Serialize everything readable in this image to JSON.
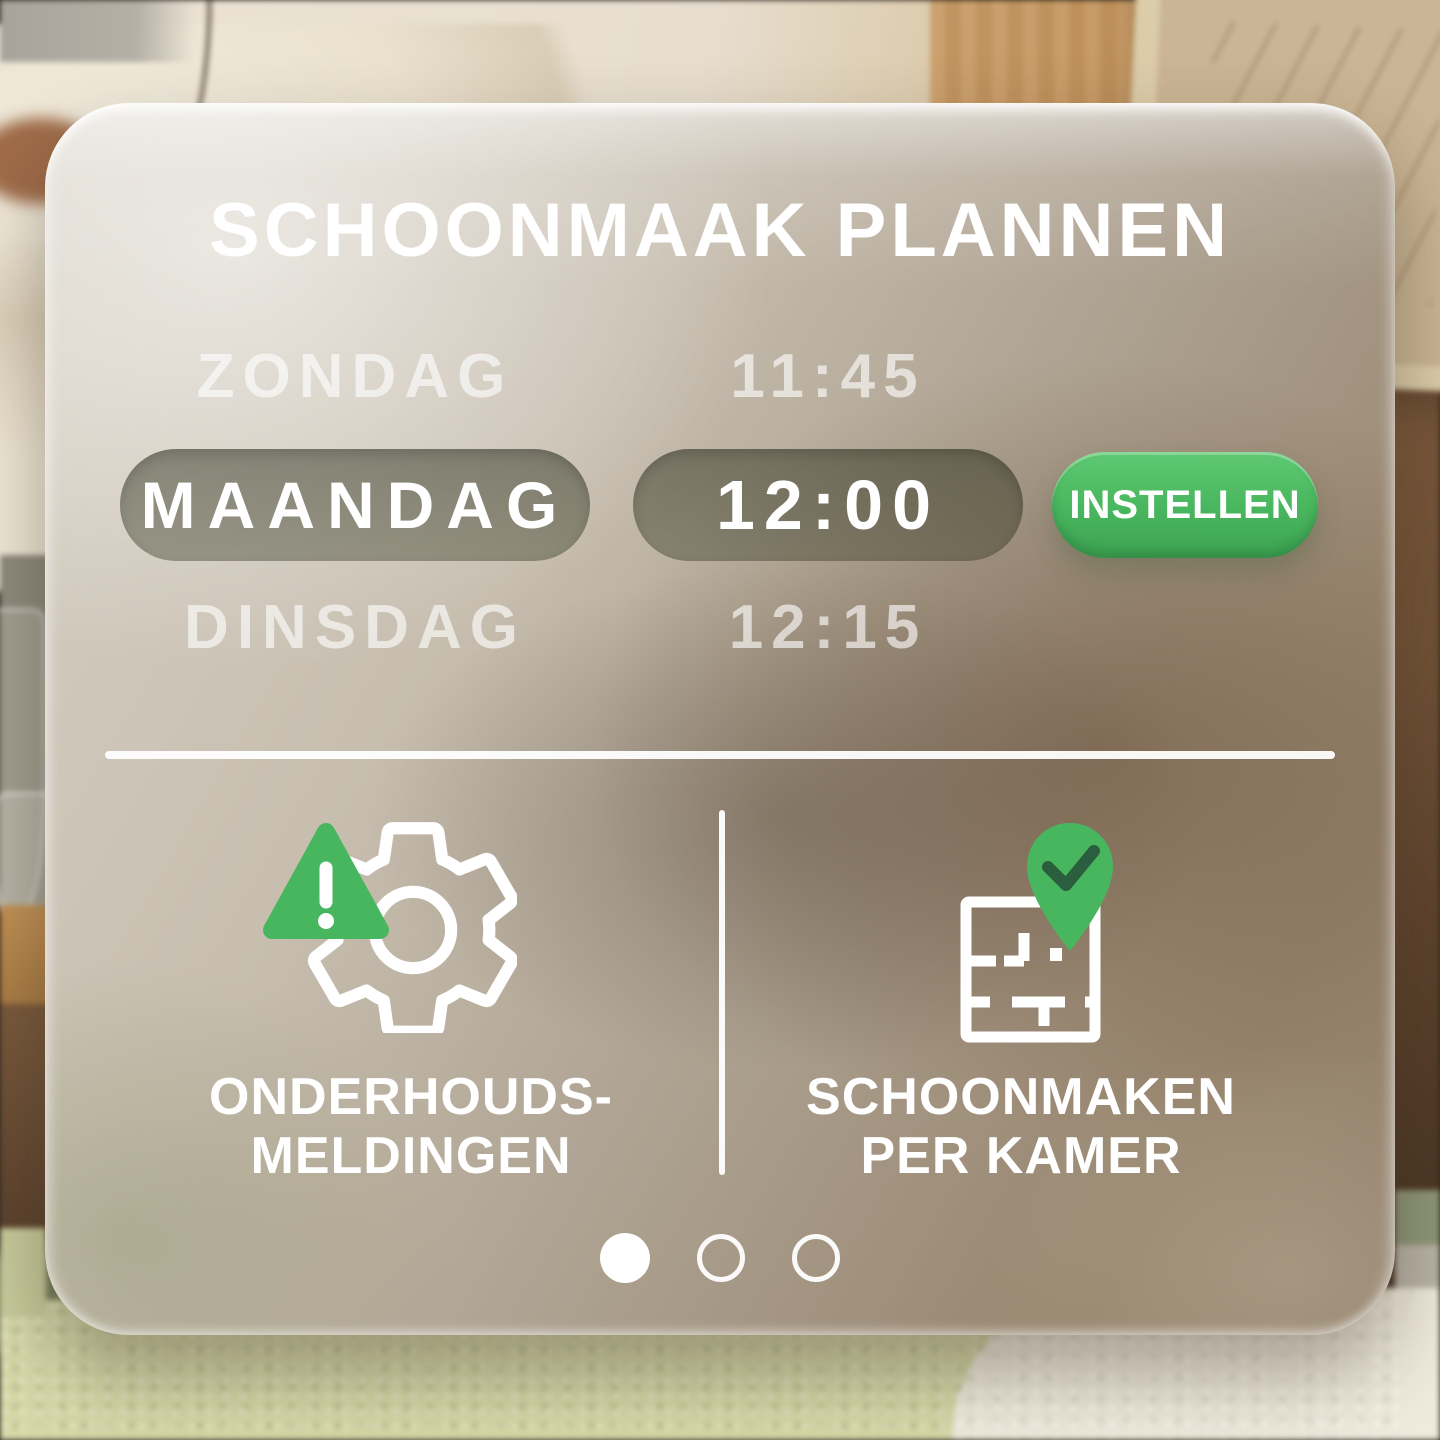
{
  "header": {
    "title": "SCHOONMAAK PLANNEN"
  },
  "schedule": {
    "rows": [
      {
        "day": "ZONDAG",
        "time": "11:45",
        "selected": false
      },
      {
        "day": "MAANDAG",
        "time": "12:00",
        "selected": true
      },
      {
        "day": "DINSDAG",
        "time": "12:15",
        "selected": false
      }
    ],
    "set_button": "INSTELLEN"
  },
  "features": [
    {
      "icon": "alert-gear-icon",
      "label_line1": "ONDERHOUDS-",
      "label_line2": "MELDINGEN"
    },
    {
      "icon": "floorplan-pin-check-icon",
      "label_line1": "SCHOONMAKEN",
      "label_line2": "PER KAMER"
    }
  ],
  "pagination": {
    "dots": 3,
    "active_index": 0
  },
  "colors": {
    "accent_green": "#48b65e",
    "accent_green_light": "#5ec972",
    "accent_green_dark": "#3da352",
    "check_dark_green": "#2b5e3f",
    "text_bright": "#ffffff",
    "text_dim": "rgba(255,255,255,0.62)"
  }
}
